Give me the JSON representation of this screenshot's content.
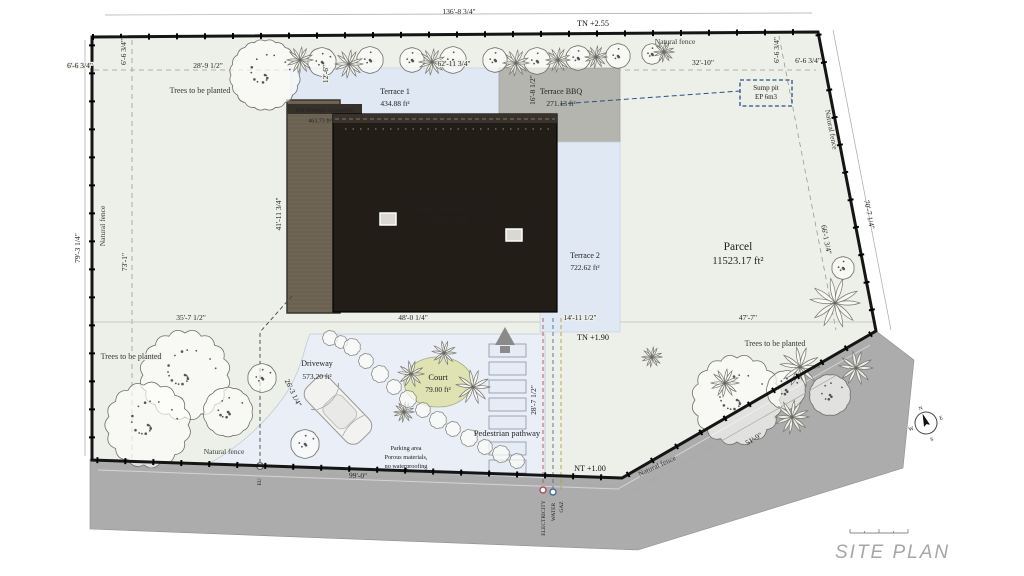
{
  "drawing_title": "SITE PLAN",
  "levels": {
    "top": "TN +2.55",
    "mid": "TN +1.90",
    "bottom": "NT +1.00"
  },
  "parcel": {
    "name": "Parcel",
    "area": "11523.17 ft²"
  },
  "building": {
    "roof_label": "Singe slope roof10%",
    "roof_area": "3230.13 ft²",
    "deck_label": "Toit Terrasse Accessible",
    "deck_area": "463.73 ft²"
  },
  "terraces": {
    "terrace1_name": "Terrace 1",
    "terrace1_area": "434.88 ft²",
    "bbq_name": "Terrace BBQ",
    "bbq_area": "271.13 ft²",
    "terrace2_name": "Terrace 2",
    "terrace2_area": "722.62 ft²"
  },
  "outdoor": {
    "driveway_name": "Driveway",
    "driveway_area": "573.20 ft²",
    "court_name": "Court",
    "court_area": "79.00 ft²",
    "pathway_label": "Pedestrian pathway",
    "parking_line1": "Parking area",
    "parking_line2": "Porous materials,",
    "parking_line3": "no waterproofing"
  },
  "dims": {
    "overall_top": "136'-8 3/4\"",
    "top_left_offset_h": "6'-6 3/4\"",
    "top_left_offset_v": "6'-6 3/4\"",
    "top_28_9": "28'-9 1/2\"",
    "top_12_6": "12'-6\"",
    "top_62_11": "62'-11 3/4\"",
    "top_16_8": "16'-8 1/2\"",
    "top_32_10": "32'-10\"",
    "top_right_offset_v": "6'-6 3/4\"",
    "top_right_offset_h": "6'-6 3/4\"",
    "left_overall": "79'-3 1/4\"",
    "left_setback": "73'-1\"",
    "deck_side": "41'-11 3/4\"",
    "roof_side": "38'-7 1/2\"",
    "right_overall": "70'-7 1/4\"",
    "right_setback": "66'-1 3/4\"",
    "mid_35_7": "35'-7 1/2\"",
    "mid_48_0": "48'-0 1/4\"",
    "mid_14_11": "14'-11 1/2\"",
    "mid_47_7": "47'-7\"",
    "driveway_side": "26'-3 1/4\"",
    "pathway_side": "28'-7 1/2\"",
    "bottom_99_0": "99'-0\"",
    "bottom_51_9": "51'-9\""
  },
  "fences": {
    "top": "Natural fence",
    "left": "Natural fence",
    "right": "Natural fence",
    "bottom": "Natural fence",
    "bottom_right": "Natural fence"
  },
  "plantings": {
    "left_top": "Trees to be planted",
    "left_bottom": "Trees to be planted",
    "right": "Trees to be planted"
  },
  "utilities": {
    "sump_line1": "Sump pit",
    "sump_line2": "EP 6m3",
    "electricity": "ELECTRICITY",
    "water": "WATER",
    "gaz": "GAZ",
    "sewer": "EU"
  },
  "compass": {
    "n": "N",
    "e": "E",
    "s": "S",
    "w": "W"
  },
  "colors": {
    "parcel": "#edf0e9",
    "road": "#acacac",
    "roof": "#221d17",
    "roof_band": "#38322a",
    "deck": "#6f6555",
    "terrace": "#dfe8f3",
    "terrace_bbq": "#b5b5b0",
    "driveway": "#e9eef7",
    "court": "#dfe3b4",
    "pathway_step": "#e6ecf6",
    "sump_outline": "#2d4f86",
    "electric_line": "#b05050",
    "water_line": "#4a6a9a",
    "gaz_line": "#b0a040"
  }
}
